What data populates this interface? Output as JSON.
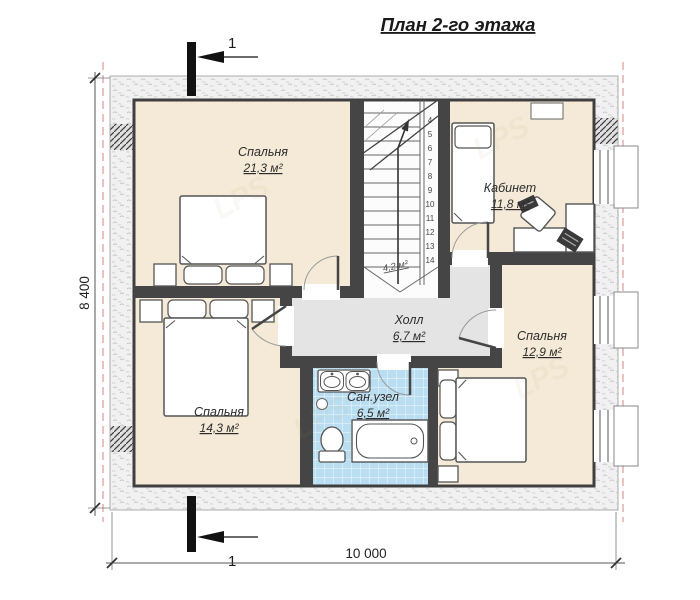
{
  "title": "План 2-го этажа",
  "section_label": "1",
  "dims": {
    "height": "8 400",
    "width": "10 000"
  },
  "rooms": {
    "bedroom1": {
      "name": "Спальня",
      "area": "21,3 м²"
    },
    "office": {
      "name": "Кабинет",
      "area": "11,8 м²"
    },
    "hall": {
      "name": "Холл",
      "area": "6,7 м²"
    },
    "bedroom2": {
      "name": "Спальня",
      "area": "12,9 м²"
    },
    "bedroom3": {
      "name": "Спальня",
      "area": "14,3 м²"
    },
    "bathroom": {
      "name": "Сан.узел",
      "area": "6,5 м²"
    },
    "stairs_area": "4,2 м²"
  },
  "stairs": {
    "steps": [
      "4",
      "5",
      "6",
      "7",
      "8",
      "9",
      "10",
      "11",
      "12",
      "13",
      "14"
    ]
  },
  "watermark": "LPS",
  "colors": {
    "floor": "#f4ead7",
    "hall_floor": "#e4e4e4",
    "bath_floor": "#badef1",
    "wall": "#454545",
    "roof_line": "#dfa0a0"
  }
}
